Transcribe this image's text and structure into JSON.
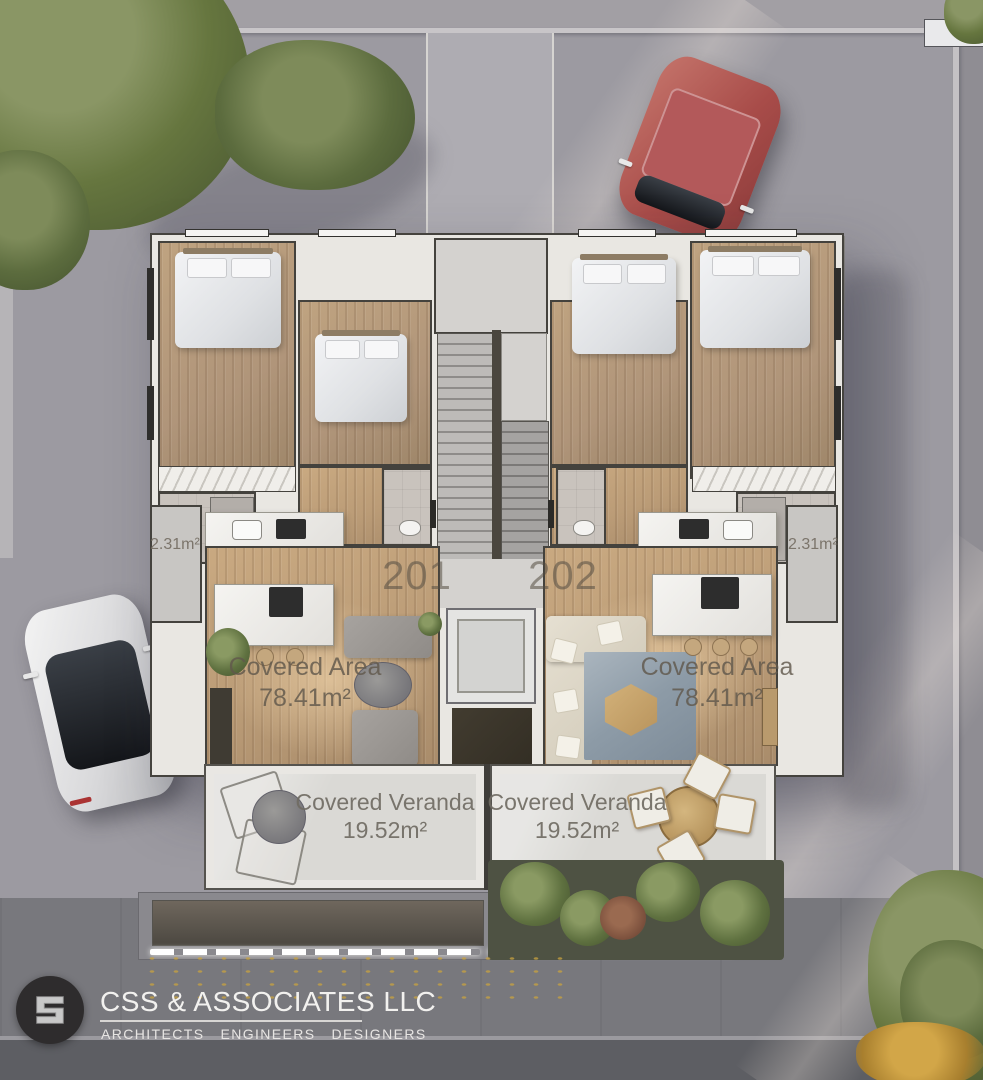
{
  "floor_plan": {
    "units": [
      {
        "number": "201",
        "covered_area_label": "Covered Area",
        "covered_area_value": "78.41m²",
        "veranda_label": "Covered Veranda",
        "veranda_value": "19.52m²",
        "balcony_area_value": "2.31m²"
      },
      {
        "number": "202",
        "covered_area_label": "Covered Area",
        "covered_area_value": "78.41m²",
        "veranda_label": "Covered Veranda",
        "veranda_value": "19.52m²",
        "balcony_area_value": "2.31m²"
      }
    ]
  },
  "branding": {
    "company_name": "CSS & ASSOCIATES LLC",
    "tagline_words": [
      "ARCHITECTS",
      "ENGINEERS",
      "DESIGNERS"
    ],
    "logo_monogram": "S"
  },
  "colors": {
    "pavement": "#9c9aa1",
    "wood_floor": "#bb9c77",
    "veranda_concrete": "#dad9d5",
    "label_text": "#60584c",
    "car_red": "#a84c49",
    "car_white": "#e9e9e9",
    "tree_green": "#5c6c3e",
    "logo_background": "#2e2c2d",
    "logo_text": "#f2f1ef"
  }
}
